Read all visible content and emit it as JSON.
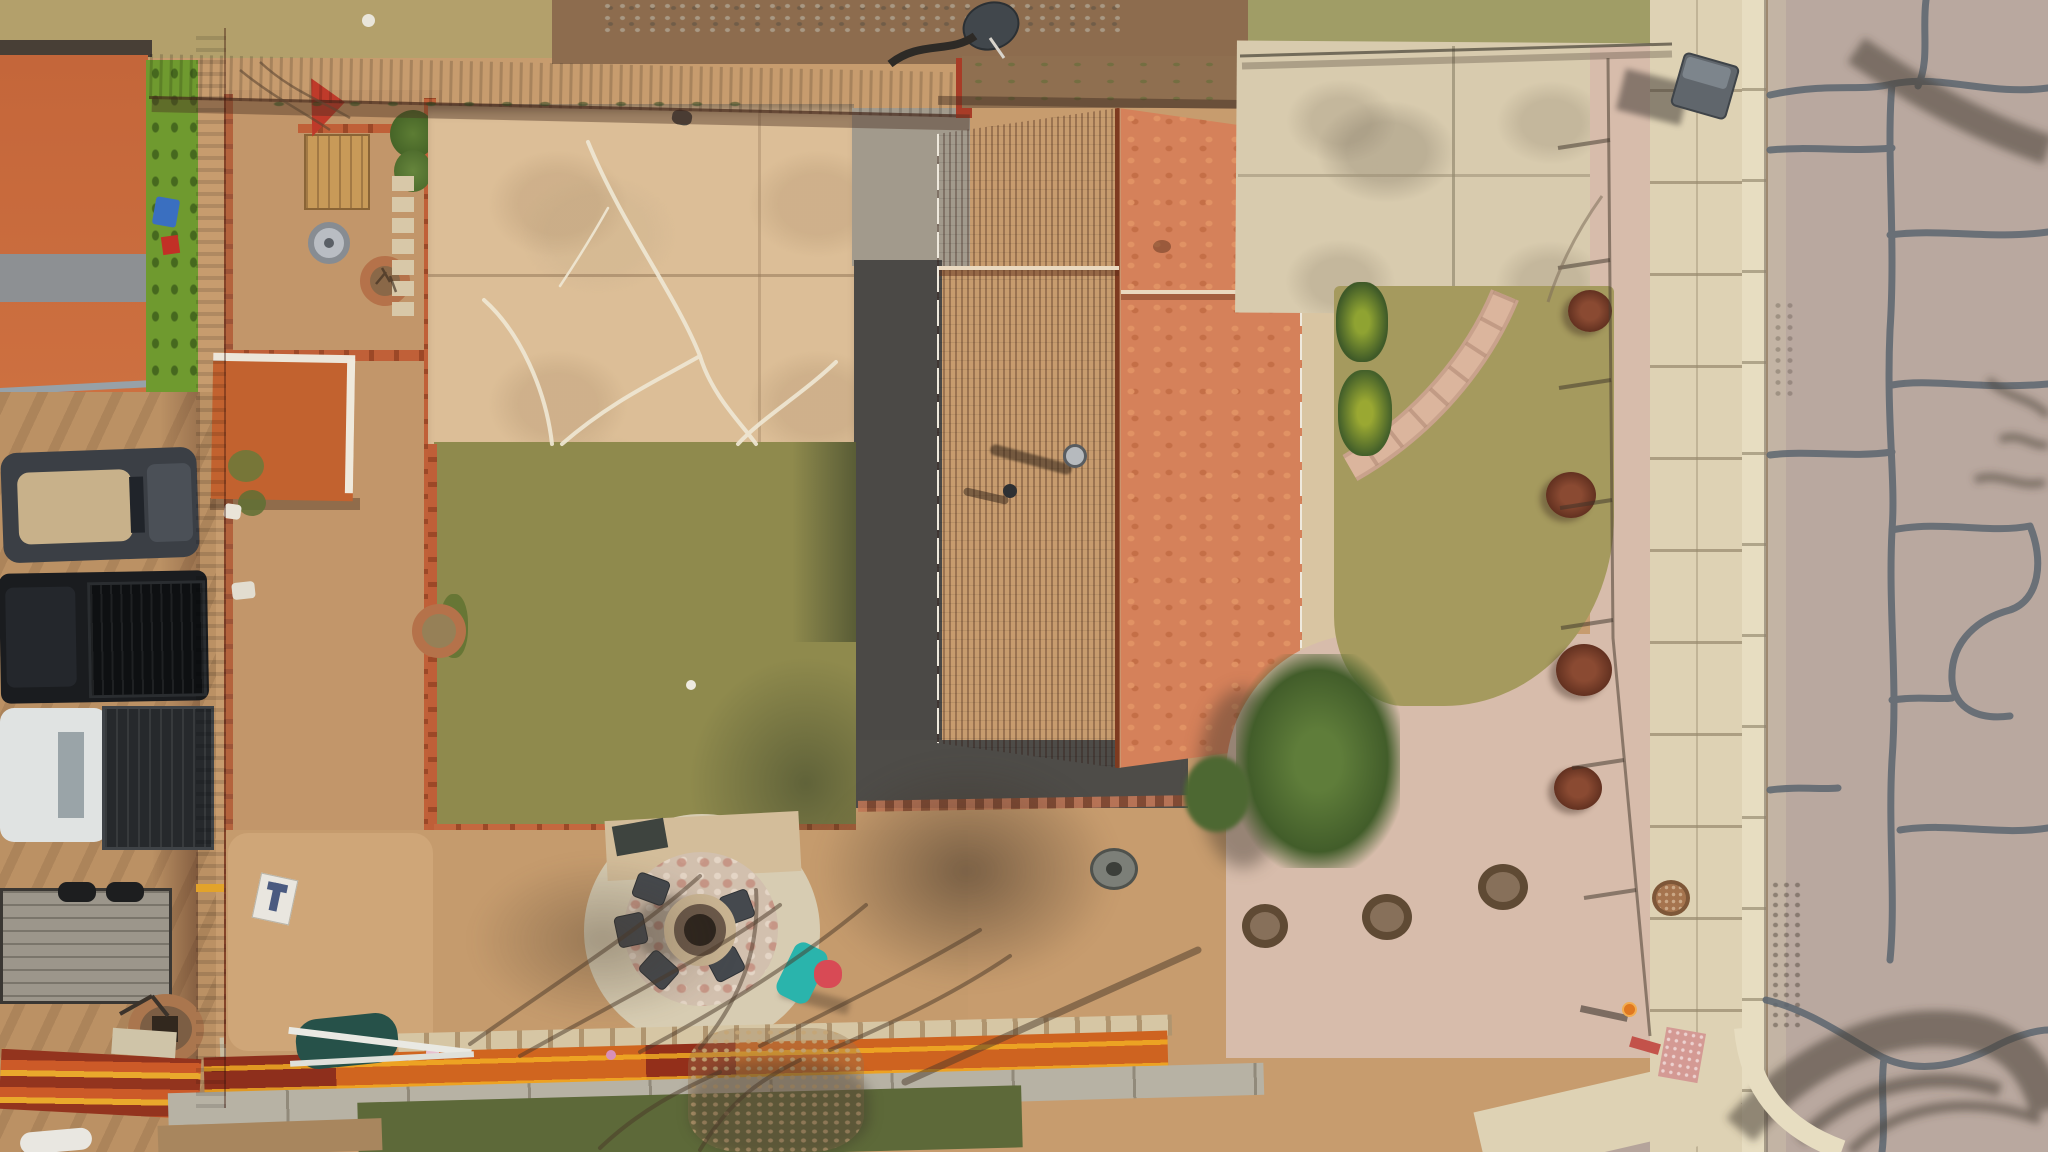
{
  "scene": {
    "type": "aerial-drone-photo",
    "setting": "overhead top-down view of a suburban residential property",
    "description": "Drone photo looking straight down on a house with an orange shingle gable roof, backyard with patchy lawn, concrete patio, circular gravel fire-pit patio with chairs, kids slide, red wooden privacy fences, a shed, a dirt side yard with parked pickup trucks and a flatbed trailer, xeriscaped front yard with pink rock mulch and flagstone walkway, concrete sidewalk, curb and a cracked asphalt street with tar seal lines and tree shadows.",
    "width": 2048,
    "height": 1152
  },
  "palette": {
    "dirt_base": "#c79c6e",
    "dirt_light": "#cfa678",
    "dirt_side": "#bb9164",
    "dead_grass": "#b3a06b",
    "neighbor_grass": "#a09d66",
    "rubble_dirt": "#8d6c4e",
    "turf_green": "#6f9a2f",
    "neighbor_roof": "#c4663a",
    "neighbor_ridge": "#8d9093",
    "shed_roof": "#c2622f",
    "red_fence": "#aa3d28",
    "red_fence_sunlit": "#d4512c",
    "rail_orange": "#d0651f",
    "rail_yellow": "#e9a92c",
    "concrete_patio": "#dcbe97",
    "concrete_gray": "#a29a8c",
    "crack_white": "#efe7d3",
    "lawn_back": "#8f8a4d",
    "lawn_front": "#a59a5e",
    "brick_border": "#c06038",
    "gravel_dark": "#4b4946",
    "gravel_pea": "#d7ccb2",
    "gravel_pink": "#d7bcab",
    "flagstone": "#d2c0ae",
    "flagstone_pink": "#c38f7e",
    "roof_left_shaded": "#a84e2c",
    "roof_right_sunlit": "#d5815a",
    "roof_ridge_dark": "#7e3a20",
    "gutter_white": "#efe9dd",
    "driveway": "#d8cbae",
    "sidewalk": "#ded2b4",
    "curb": "#e7ddc1",
    "street": "#b9a89f",
    "street_crack": "#5c6670",
    "shadow_warm": "rgba(70,52,38,0.5)",
    "slide_teal": "#2ab4ac",
    "slide_red": "#d84a55",
    "truck_black": "#1a1c1f",
    "truck_white": "#e0e3e2",
    "convertible_top_tan": "#c8b18a",
    "trailer_wood": "#9c968b",
    "chair_gray": "#45494e",
    "fire_ring_brick": "#aa764e",
    "wheelbarrow_green": "#265149",
    "hydrant_orange": "#e07820",
    "manhole_brown": "#a5744e",
    "tree_green": "#5f7d3a",
    "shrub_red": "#8a4a32"
  },
  "objects": {
    "neighbor_house_roof": "neighboring house orange shingle roof with gray ridge section",
    "neighbor_turf_strip": "bright green artificial turf strip",
    "neighbor_dirt_driveway": "dirt side driveway with tire tracks",
    "convertible_car": "dark convertible car with tan soft top",
    "black_pickup_truck": "black pickup truck with open bed",
    "white_pickup_truck": "white pickup truck with dark bed",
    "flatbed_trailer": "weathered wood flatbed trailer with tires",
    "brick_fire_ring": "round brick fire ring",
    "stacked_fence_panels": "stacked orange and yellow painted fence panels",
    "sign_t": "small white sign leaning on fence",
    "wheelbarrow": "green wheelbarrow with white ladder",
    "red_privacy_fence_west": "red wooden privacy fence running north-south",
    "red_privacy_fence_north": "red wooden privacy fence along back of yard",
    "storage_shed": "small shed with orange shingle roof",
    "garden_bed": "dirt garden bed with red brick borders",
    "wood_planter_box": "wooden planter box",
    "red_tarp": "red tarp",
    "spare_wheel": "chrome wheel rim",
    "round_brick_planter": "round brick planter with bare shrub",
    "stepping_stone_path": "brick stepping-stone path",
    "concrete_patio": "large tan concrete patio with white cracks",
    "back_lawn": "patchy olive backyard lawn with brick border",
    "fire_pit_patio": "circular pea-gravel and flagstone fire pit patio",
    "fire_pit": "round central fire pit",
    "patio_chairs": "dark chairs around fire pit",
    "kids_slide": "teal and red toddler slide",
    "gravel_strip": "dark gray rock mulch strip beside house",
    "main_house_roof": "main house gable roof, shaded left slope and sunlit right slope",
    "roof_vents": "roof vent pipes with long shadows",
    "white_gutters": "white gutters along eaves",
    "driveway": "concrete driveway",
    "trash_bin": "gray trash bin at curb",
    "front_lawn": "patchy front lawn",
    "flagstone_walkway": "curved flagstone walkway to front door",
    "evergreen_shrubs": "evergreen shrubs along house",
    "shade_tree": "leafy green tree at front corner",
    "rock_mulch_bed": "pink rock mulch landscape bed",
    "red_shrubs": "small reddish-brown shrubs",
    "tree_rings": "dark rings with young plantings",
    "chain_link_fence": "low chain-link fence around front yard",
    "sidewalk": "concrete sidewalk with expansion joints",
    "manhole_cover": "brown round utility cover in sidewalk",
    "fire_hydrant": "orange fire hydrant",
    "curb_ramp": "pink tactile curb ramp pad",
    "curb_gutter": "concrete curb and gutter",
    "street": "asphalt street with dark tar crack seal lines",
    "tree_shadows": "tree branch shadows on street and yard",
    "satellite_dish": "satellite dish in rear neighbor yard",
    "block_retaining_wall": "light block retaining wall cap along south fence",
    "rear_walkway": "rear concrete walkway",
    "rear_grass_strip": "green grass strip behind rear fence",
    "dirt_south_yard": "bare dirt play area with tree shadows",
    "gray_bowl": "gray round tub"
  }
}
